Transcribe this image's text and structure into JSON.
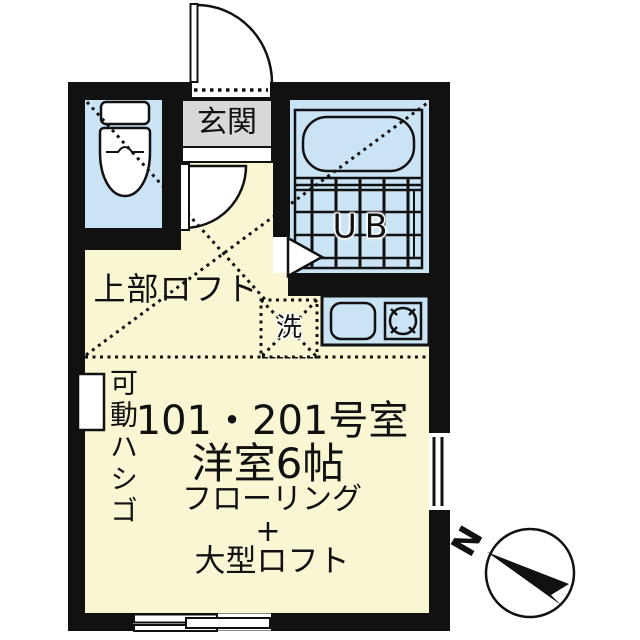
{
  "title": "floor-plan-101-201",
  "colors": {
    "wall": "#111111",
    "line": "#111111",
    "floor": "#FAF5D2",
    "wet": "#CBE4F5",
    "genkan": "#D8D8D8",
    "paper": "#FFFFFF"
  },
  "labels": {
    "genkan": "玄関",
    "unit_bath": "UB",
    "upper_loft": "上部ロフト",
    "laundry": "洗",
    "ladder": "可動ハシゴ",
    "compass_north": "N"
  },
  "room_info": {
    "line1": "101・201号室",
    "line2": "洋室6帖",
    "line3": "フローリング",
    "line4": "+",
    "line5": "大型ロフト"
  },
  "icons": [
    "toilet-icon",
    "bathtub-icon",
    "bath-grating-icon",
    "sink-icon",
    "stove-burner-icon",
    "entrance-door-arc-icon",
    "interior-door-arc-icon",
    "bath-door-triangle-icon",
    "washing-machine-box-icon",
    "ladder-marker-icon",
    "window-icon",
    "compass-icon"
  ]
}
